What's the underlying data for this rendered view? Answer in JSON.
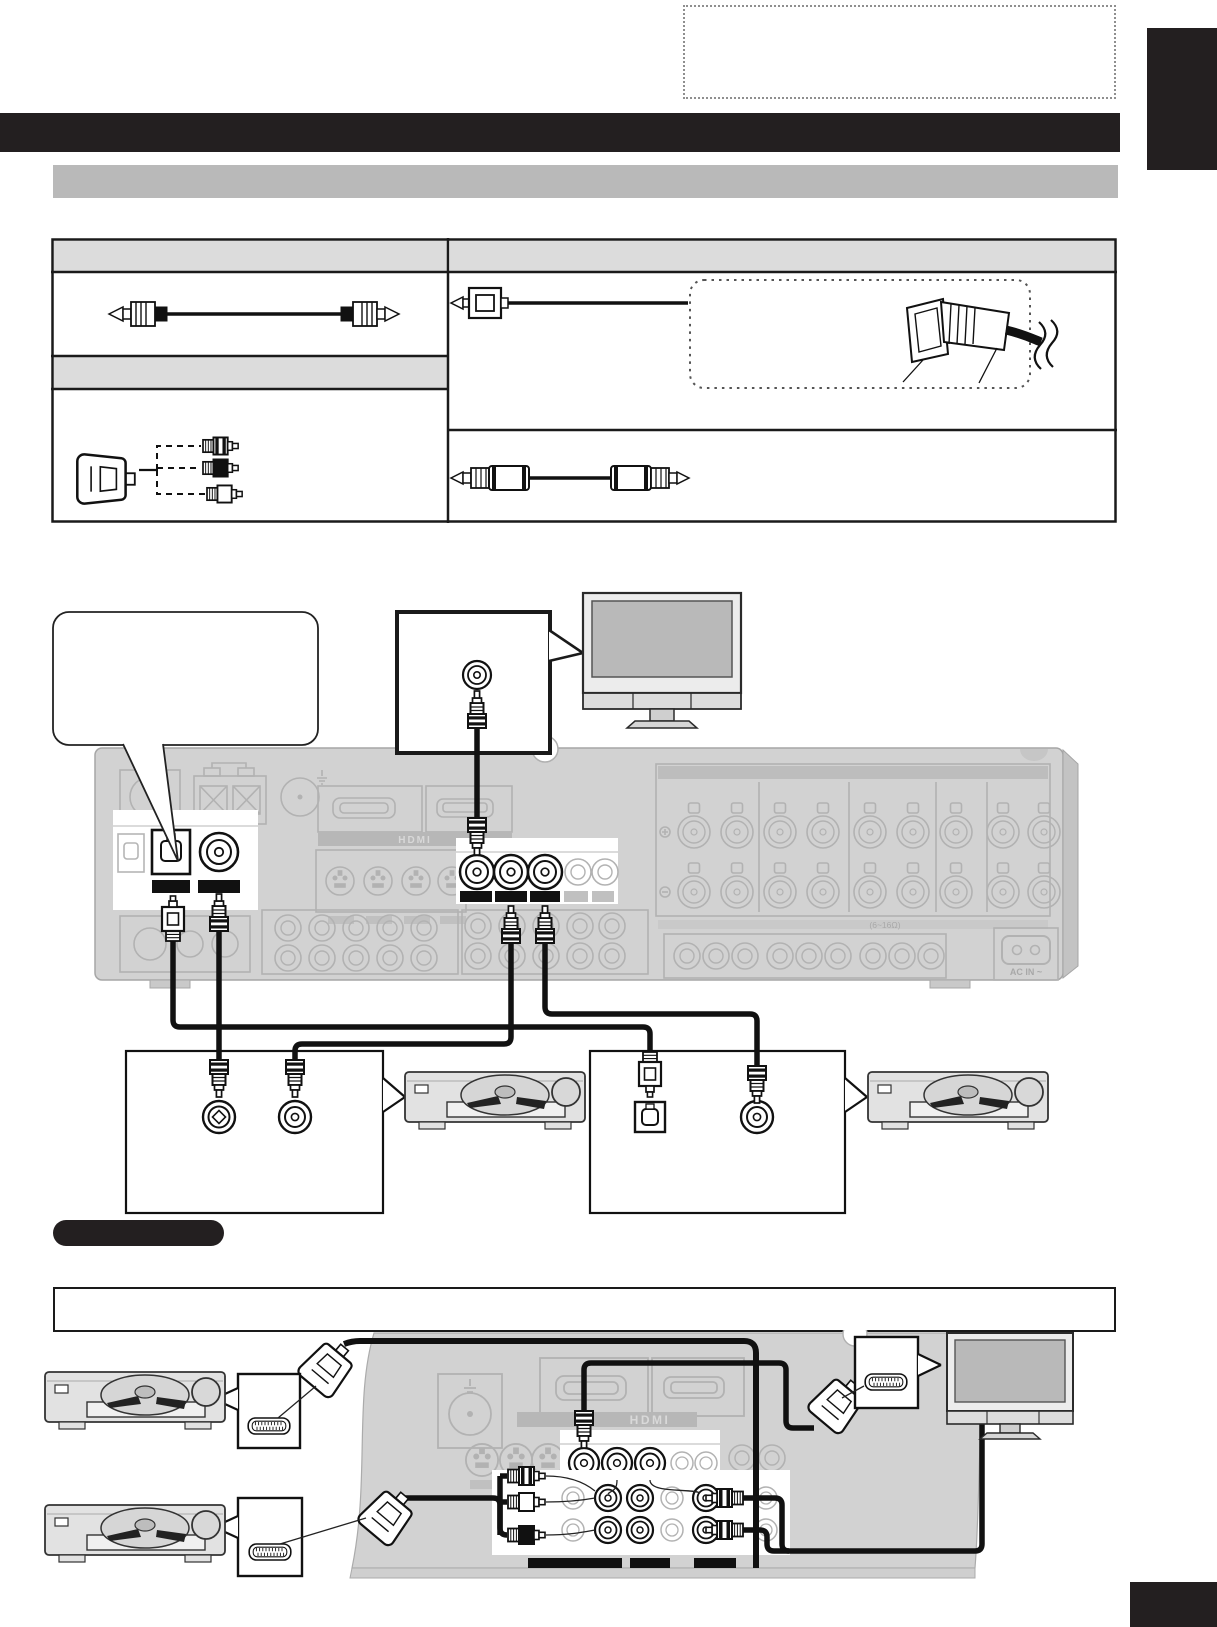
{
  "page": {
    "width": 1217,
    "height": 1627,
    "background": "#ffffff",
    "kind": "av-receiver-manual-connection-page"
  },
  "colors": {
    "ink_black": "#231f20",
    "section_bar_gray": "#b9b9b9",
    "table_header_gray": "#dcdcdc",
    "panel_gray": "#d2d2d2",
    "faded_connector_gray": "#b2b2b2",
    "cable_black": "#111111",
    "screen_gray": "#b9b9b9"
  },
  "labels": {
    "hdmi": "HDMI",
    "ac_in": "AC IN ~",
    "speaker_impedance": "(6~16Ω)"
  },
  "cable_table": {
    "columns": [
      "left",
      "right"
    ],
    "cells": [
      {
        "col": "left",
        "row": "header"
      },
      {
        "col": "left",
        "row": 1,
        "illustration": "coaxial-digital-cable-icon"
      },
      {
        "col": "left",
        "row": "header-2"
      },
      {
        "col": "left",
        "row": 2,
        "illustration": "scart-to-three-rca-adapter-icon"
      },
      {
        "col": "right",
        "row": "header"
      },
      {
        "col": "right",
        "row": 1,
        "illustration": "optical-cable-icon",
        "inset": "optical-plug-insertion-note"
      },
      {
        "col": "right",
        "row": 2,
        "illustration": "stereo-rca-cable-icon"
      }
    ]
  },
  "top_diagram": {
    "devices": [
      "tv",
      "dvd-player",
      "dvd-player"
    ],
    "receiver_highlights": [
      "optical-digital-in-jack",
      "coaxial-digital-in-jack",
      "monitor-out-jack",
      "audio-in-left-jack",
      "audio-in-right-jack"
    ],
    "callouts": [
      "rounded-speech-bubble",
      "monitor-out-callout",
      "digital-audio-callout",
      "optical-audio-callout"
    ]
  },
  "bottom_diagram": {
    "devices": [
      "dvd-player",
      "dvd-player",
      "tv"
    ],
    "connectors": [
      "scart-plug",
      "scart-plug",
      "scart-plug"
    ],
    "callouts": [
      "scart-callout",
      "scart-callout",
      "scart-callout"
    ]
  },
  "footer": {
    "note_pill_color": "#231f20",
    "corner_mark_color": "#231f20"
  }
}
